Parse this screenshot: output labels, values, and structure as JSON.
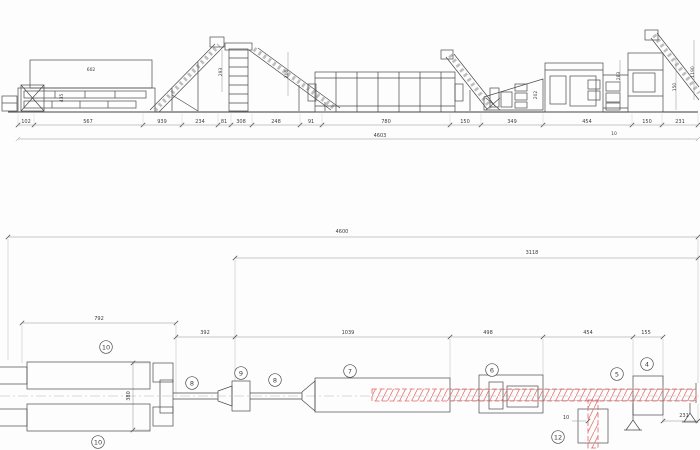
{
  "colors": {
    "line": "#4a4a4a",
    "light_line": "#b0b0b0",
    "accent_red": "#e06666",
    "hatch_red": "#e57373",
    "background": "#fdfdfd"
  },
  "elevation": {
    "total_dim": {
      "v": "4603",
      "x": 380,
      "y": 137
    },
    "dim_ticks": [
      18,
      34,
      143,
      182,
      218,
      231,
      252,
      300,
      322,
      450,
      481,
      543,
      632,
      662,
      698
    ],
    "baseline_dims": [
      {
        "v": "102",
        "x": 26,
        "y": 123
      },
      {
        "v": "567",
        "x": 88,
        "y": 123
      },
      {
        "v": "939",
        "x": 162,
        "y": 123
      },
      {
        "v": "234",
        "x": 200,
        "y": 123
      },
      {
        "v": "81",
        "x": 224,
        "y": 123
      },
      {
        "v": "308",
        "x": 241,
        "y": 123
      },
      {
        "v": "248",
        "x": 276,
        "y": 123
      },
      {
        "v": "91",
        "x": 311,
        "y": 123
      },
      {
        "v": "780",
        "x": 386,
        "y": 123
      },
      {
        "v": "150",
        "x": 465,
        "y": 123
      },
      {
        "v": "349",
        "x": 512,
        "y": 123
      },
      {
        "v": "454",
        "x": 587,
        "y": 123
      },
      {
        "v": "150",
        "x": 647,
        "y": 123
      },
      {
        "v": "231",
        "x": 680,
        "y": 123
      }
    ],
    "machine_dims": [
      {
        "v": "602",
        "x": 91,
        "y": 71,
        "rot": 0
      },
      {
        "v": "435",
        "x": 63,
        "y": 98,
        "rot": -90
      },
      {
        "v": "293",
        "x": 222,
        "y": 72,
        "rot": -90
      },
      {
        "v": "206",
        "x": 288,
        "y": 74,
        "rot": -90
      },
      {
        "v": "202",
        "x": 537,
        "y": 95,
        "rot": -90
      },
      {
        "v": "283",
        "x": 620,
        "y": 76,
        "rot": -90
      },
      {
        "v": "150",
        "x": 676,
        "y": 87,
        "rot": -90
      },
      {
        "v": "1190",
        "x": 694,
        "y": 72,
        "rot": -90
      },
      {
        "v": "10",
        "x": 614,
        "y": 135,
        "rot": 0
      }
    ]
  },
  "plan": {
    "overall_dim": {
      "v": "4600",
      "x": 342,
      "y": 233
    },
    "chain_dim": {
      "v": "3118",
      "x": 532,
      "y": 254
    },
    "row_dims": [
      {
        "v": "792",
        "x": 99,
        "y": 320,
        "rot": 0
      },
      {
        "v": "392",
        "x": 205,
        "y": 334,
        "rot": 0
      },
      {
        "v": "1039",
        "x": 348,
        "y": 334,
        "rot": 0
      },
      {
        "v": "498",
        "x": 488,
        "y": 334,
        "rot": 0
      },
      {
        "v": "454",
        "x": 588,
        "y": 334,
        "rot": 0
      },
      {
        "v": "155",
        "x": 646,
        "y": 334,
        "rot": 0
      },
      {
        "v": "231",
        "x": 684,
        "y": 417,
        "rot": 0
      },
      {
        "v": "10",
        "x": 566,
        "y": 419,
        "rot": 0
      },
      {
        "v": "380",
        "x": 130,
        "y": 396,
        "rot": -90
      }
    ],
    "tick_rows": [
      {
        "y": 237,
        "xs": [
          8,
          698
        ]
      },
      {
        "y": 258,
        "xs": [
          235,
          698
        ]
      },
      {
        "y": 323,
        "xs": [
          22,
          176
        ]
      },
      {
        "y": 337,
        "xs": [
          176,
          235,
          450,
          543,
          633,
          663
        ]
      },
      {
        "y": 421,
        "xs": [
          663,
          698
        ]
      }
    ],
    "balloons": [
      {
        "n": "10",
        "x": 106,
        "y": 347
      },
      {
        "n": "10",
        "x": 98,
        "y": 442
      },
      {
        "n": "8",
        "x": 192,
        "y": 383
      },
      {
        "n": "9",
        "x": 241,
        "y": 373
      },
      {
        "n": "8",
        "x": 275,
        "y": 380
      },
      {
        "n": "7",
        "x": 350,
        "y": 371
      },
      {
        "n": "6",
        "x": 492,
        "y": 370
      },
      {
        "n": "5",
        "x": 617,
        "y": 374
      },
      {
        "n": "4",
        "x": 647,
        "y": 364
      },
      {
        "n": "12",
        "x": 558,
        "y": 437
      }
    ]
  }
}
